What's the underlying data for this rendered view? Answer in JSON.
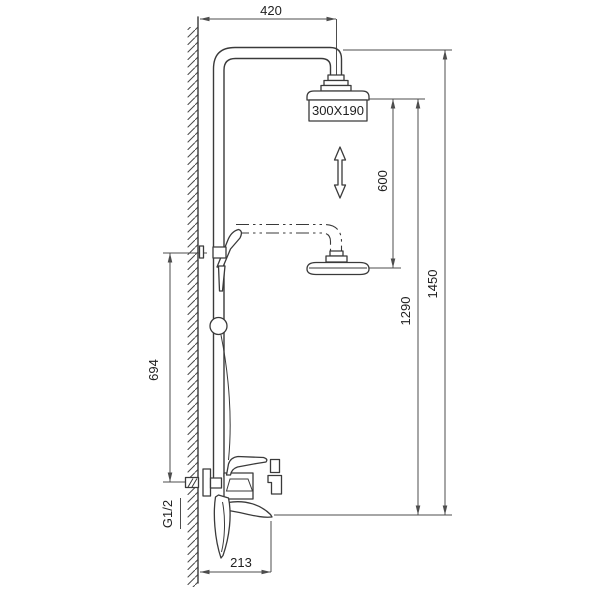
{
  "drawing": {
    "type": "technical-dimension-drawing",
    "subject": "wall-mounted shower column with overhead shower, hand shower and mixer",
    "colors": {
      "background": "#ffffff",
      "product_line": "#3a3a3a",
      "dimension_line": "#4d4d4d",
      "text": "#1f1f1f"
    }
  },
  "dimensions": {
    "top_offset": "420",
    "head_size": "300X190",
    "adjust_range": "600",
    "lower_height": "1290",
    "total_height": "1450",
    "bracket_height": "694",
    "thread_size": "G1/2",
    "spout_reach": "213"
  }
}
